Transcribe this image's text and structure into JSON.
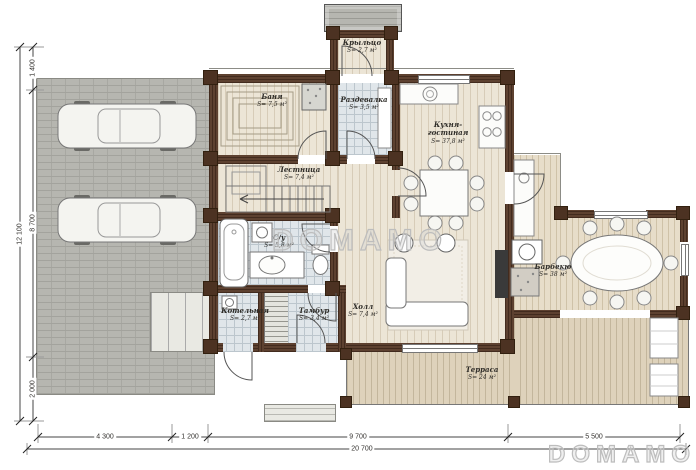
{
  "watermark": {
    "center": "DOMAMO",
    "corner": "DOMAMO"
  },
  "rooms": [
    {
      "id": "porch",
      "name": "Крыльцо",
      "area": "S= 2,7 м²"
    },
    {
      "id": "sauna",
      "name": "Баня",
      "area": "S= 7,5 м²"
    },
    {
      "id": "dressing",
      "name": "Раздевалка",
      "area": "S= 3,5 м²"
    },
    {
      "id": "stairs",
      "name": "Лестница",
      "area": "S= 7,4 м²"
    },
    {
      "id": "kitchen",
      "name": "Кухня-гостиная",
      "area": "S= 37,8 м²"
    },
    {
      "id": "bathroom",
      "name": "С/у",
      "area": "S= 5,8 м²"
    },
    {
      "id": "boiler",
      "name": "Котельная",
      "area": "S= 2,7 м²"
    },
    {
      "id": "vestibule",
      "name": "Тамбур",
      "area": "S= 3,4 м²"
    },
    {
      "id": "hall",
      "name": "Холл",
      "area": "S= 7,4 м²"
    },
    {
      "id": "bbq",
      "name": "Барбекю",
      "area": "S= 38 м²"
    },
    {
      "id": "terrace",
      "name": "Терраса",
      "area": "S= 24 м²"
    }
  ],
  "dimensions": {
    "bottom": {
      "segments": [
        "4 300",
        "1 200",
        "9 700",
        "5 500"
      ],
      "total": "20 700"
    },
    "left": {
      "segments": [
        "1 400",
        "8 700",
        "2 000"
      ],
      "total": "12 100"
    }
  },
  "colors": {
    "wall": "#5d4130",
    "wood_floor": "#ece5d6",
    "tile_floor": "#e0e6ea",
    "terrace_floor": "#ded2bb",
    "garage_surface": "#b6b6b0",
    "label_text": "#2e2c28",
    "watermark": "#bdbdbd"
  }
}
